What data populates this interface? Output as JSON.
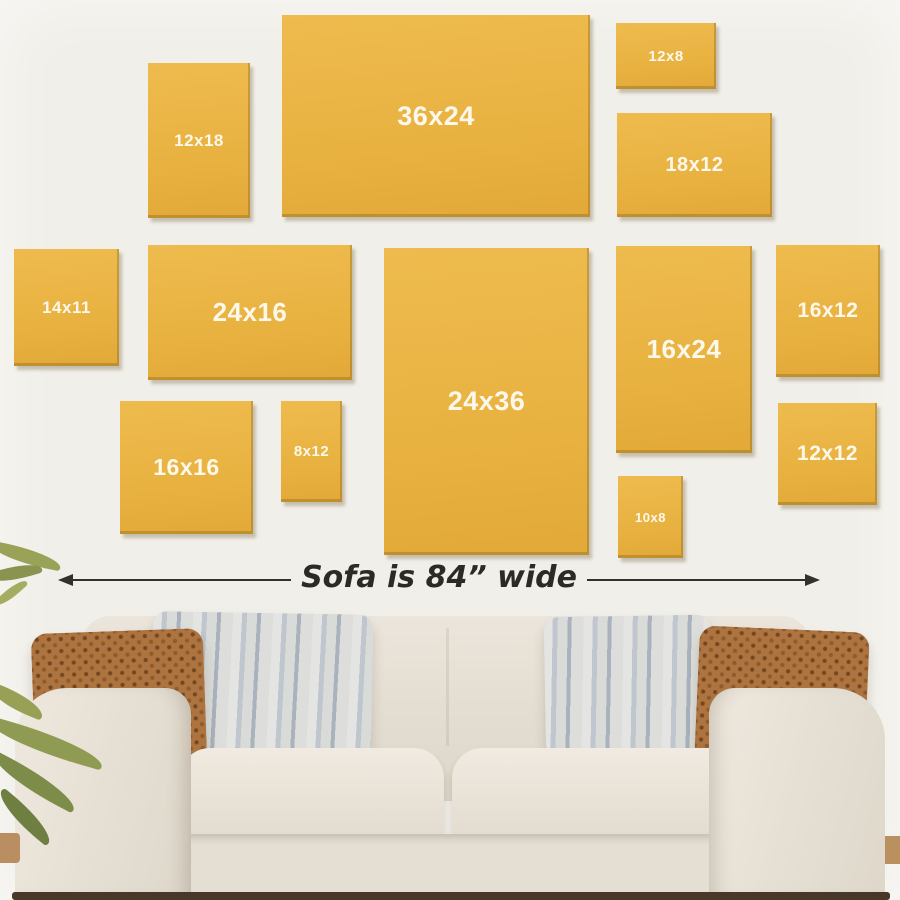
{
  "meta": {
    "title": "Canvas print size guide above sofa"
  },
  "colors": {
    "wall": "#f1efe9",
    "canvas": "#e9b342",
    "label_text": "#fdf8ec",
    "arrow": "#33312e",
    "sofa_fabric": "#e7e1d6",
    "pillow_brown": "#ad7440",
    "pillow_gray_light": "#dedfdc",
    "pillow_gray_dark": "#aab3bf",
    "floor": "#47382a",
    "plant_green": "#8f9b53"
  },
  "canvases": [
    {
      "label": "12x18",
      "x": 148,
      "y": 63,
      "w": 102,
      "h": 155,
      "font": 17
    },
    {
      "label": "36x24",
      "x": 282,
      "y": 15,
      "w": 308,
      "h": 202,
      "font": 27
    },
    {
      "label": "12x8",
      "x": 616,
      "y": 23,
      "w": 100,
      "h": 66,
      "font": 15
    },
    {
      "label": "18x12",
      "x": 617,
      "y": 113,
      "w": 155,
      "h": 104,
      "font": 20
    },
    {
      "label": "14x11",
      "x": 14,
      "y": 249,
      "w": 105,
      "h": 117,
      "font": 17
    },
    {
      "label": "24x16",
      "x": 148,
      "y": 245,
      "w": 204,
      "h": 135,
      "font": 26
    },
    {
      "label": "24x36",
      "x": 384,
      "y": 248,
      "w": 205,
      "h": 307,
      "font": 27
    },
    {
      "label": "16x24",
      "x": 616,
      "y": 246,
      "w": 136,
      "h": 207,
      "font": 26
    },
    {
      "label": "16x12",
      "x": 776,
      "y": 245,
      "w": 104,
      "h": 132,
      "font": 21
    },
    {
      "label": "16x16",
      "x": 120,
      "y": 401,
      "w": 133,
      "h": 133,
      "font": 23
    },
    {
      "label": "8x12",
      "x": 281,
      "y": 401,
      "w": 61,
      "h": 101,
      "font": 15
    },
    {
      "label": "10x8",
      "x": 618,
      "y": 476,
      "w": 65,
      "h": 82,
      "font": 13
    },
    {
      "label": "12x12",
      "x": 778,
      "y": 403,
      "w": 99,
      "h": 102,
      "font": 21
    }
  ],
  "annotation": {
    "text": "Sofa is 84” wide"
  }
}
